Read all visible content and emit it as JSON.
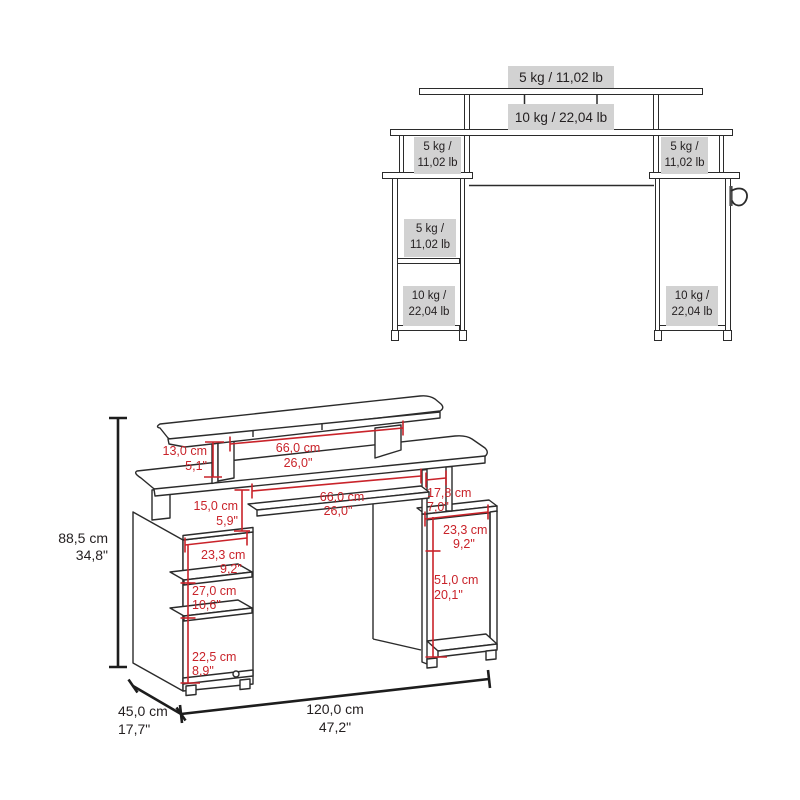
{
  "top_view": {
    "monitor_shelf_capacity": "5 kg / 11,02 lb",
    "desktop_capacity": "10 kg / 22,04 lb",
    "left_riser_capacity": [
      "5 kg /",
      "11,02 lb"
    ],
    "right_riser_capacity": [
      "5 kg /",
      "11,02 lb"
    ],
    "left_middle_shelf_capacity": [
      "5 kg /",
      "11,02 lb"
    ],
    "left_bottom_capacity": [
      "10 kg /",
      "22,04 lb"
    ],
    "right_bottom_capacity": [
      "10 kg /",
      "22,04 lb"
    ]
  },
  "dimension_view": {
    "overall_height": [
      "88,5 cm",
      "34,8\""
    ],
    "monitor_shelf_support_height": [
      "13,0 cm",
      "5,1\""
    ],
    "monitor_shelf_width": [
      "66,0 cm",
      "26,0\""
    ],
    "desktop_clearance_height": [
      "15,0 cm",
      "5,9\""
    ],
    "knee_space_width": [
      "66,0 cm",
      "26,0\""
    ],
    "right_support_depth": [
      "17,8 cm",
      "7,0\""
    ],
    "right_top_compartment_height": [
      "23,3 cm",
      "9,2\""
    ],
    "right_main_compartment_height": [
      "51,0 cm",
      "20,1\""
    ],
    "left_top_compartment_height": [
      "23,3 cm",
      "9,2\""
    ],
    "left_middle_compartment_height": [
      "27,0 cm",
      "10,6\""
    ],
    "left_bottom_compartment_height": [
      "22,5 cm",
      "8,9\""
    ],
    "overall_depth": [
      "45,0 cm",
      "17,7\""
    ],
    "overall_width": [
      "120,0 cm",
      "47,2\""
    ]
  },
  "colors": {
    "dimension_red": "#c9232a",
    "label_background": "#d2d2d2",
    "line_color": "#2b2b2b"
  }
}
